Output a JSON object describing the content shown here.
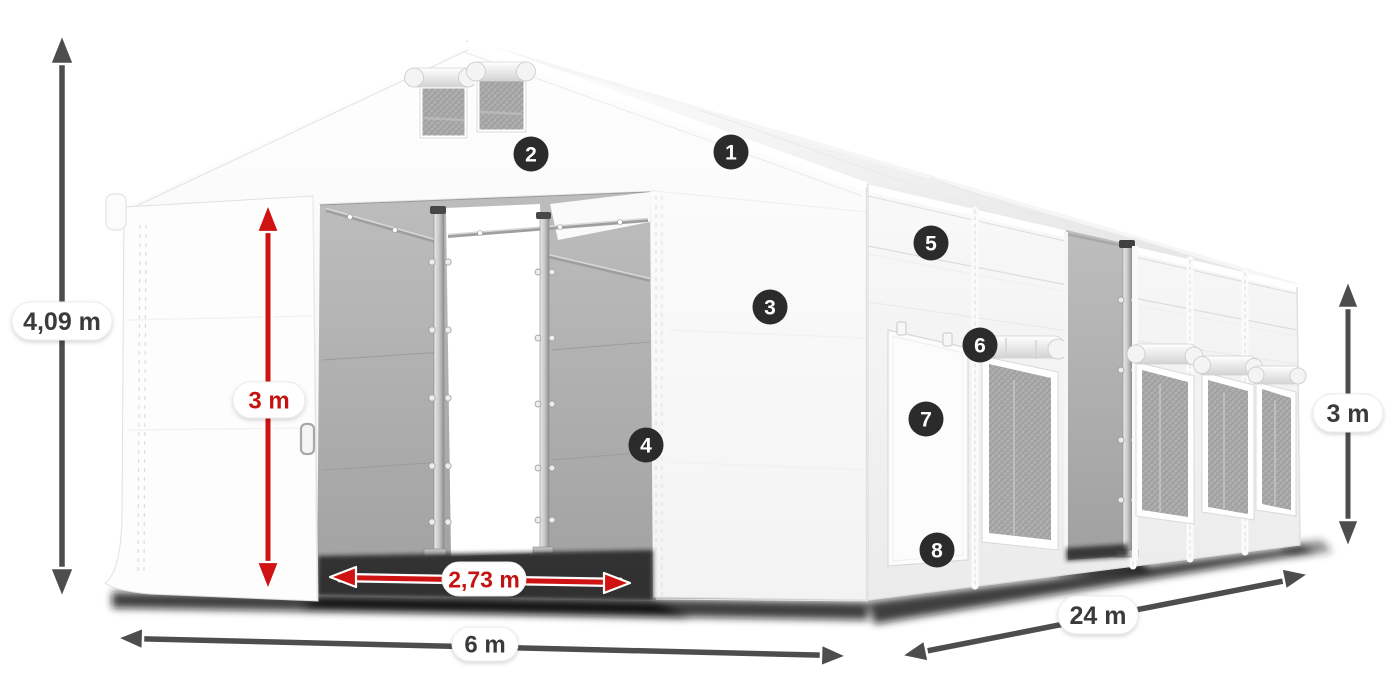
{
  "meta": {
    "title": "Tent dimension diagram",
    "subject": "White storage marquee tent with dimension arrows and numbered part callouts"
  },
  "dims": {
    "total_height": "4,09 m",
    "inner_height": "3 m",
    "door_width": "2,73 m",
    "width": "6 m",
    "length": "24 m",
    "side_height": "3 m"
  },
  "callouts": [
    "1",
    "2",
    "3",
    "4",
    "5",
    "6",
    "7",
    "8"
  ],
  "colors": {
    "dimension_red": "#c31414",
    "dimension_gray": "#4d4d4d",
    "callout_bg": "#2b2b2b",
    "label_text_dark": "#3a3a3a",
    "tent_white": "#fdfdfd",
    "interior_gray": "#aaaaaa"
  }
}
